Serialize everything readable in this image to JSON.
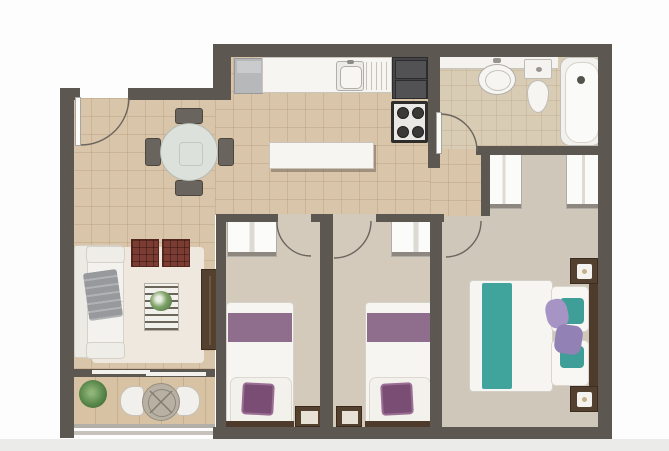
{
  "image_type": "top-down 2D architectural floor plan of a two-bedroom apartment, no visible text labels",
  "colors": {
    "wall": "#5d5751",
    "floor_tile": "#d9c5a9",
    "floor_bath": "#d9ccb5",
    "floor_bed": "#d3cabc",
    "floor_master": "#cfc7ba",
    "floor_terrace": "#d7c3a3",
    "white_furn": "#f6f5f1",
    "furn_border": "#c9c5bd",
    "wood": "#54402e",
    "purple_band": "#8f6d8c",
    "purple_cushion": "#7a4e74",
    "teal": "#41a49c",
    "lavender": "#a694c4",
    "appliance": "#454547",
    "fridge": "#b6b8b9",
    "pouf": "#7b3d33",
    "throw": "#97999d",
    "rug": "#eee8de",
    "glass": "#dce1dc",
    "railing": "#b3afa8",
    "arc": "#6b655e",
    "headboard": "#4f3b2c",
    "bottom_fade": "#ebebea"
  },
  "rooms": [
    {
      "name": "entry-dining",
      "items": [
        "entrance-door",
        "round-dining-table",
        "four-dining-chairs"
      ]
    },
    {
      "name": "kitchen",
      "items": [
        "refrigerator",
        "counter-with-sink-and-drainboard",
        "oven-microwave-tower",
        "cooktop-four-burners",
        "island-counter"
      ]
    },
    {
      "name": "bathroom",
      "items": [
        "vanity-counter",
        "round-basin-sink",
        "toilet",
        "bathtub",
        "bathroom-door"
      ]
    },
    {
      "name": "living-room",
      "items": [
        "sofa-with-gray-throw",
        "area-rug",
        "two-checkered-poufs",
        "slatted-coffee-table-with-plant",
        "tv-console"
      ]
    },
    {
      "name": "terrace",
      "items": [
        "potted-plant",
        "round-wicker-table",
        "two-bistro-chairs",
        "balcony-railing",
        "sliding-door"
      ]
    },
    {
      "name": "bedroom-1",
      "items": [
        "wardrobe",
        "single-bed-purple-accent",
        "purple-cushion",
        "wall-frame",
        "door"
      ]
    },
    {
      "name": "bedroom-2",
      "items": [
        "wardrobe",
        "single-bed-purple-accent",
        "purple-cushion",
        "wall-frame",
        "door"
      ]
    },
    {
      "name": "master-bedroom",
      "items": [
        "two-wardrobes",
        "double-bed-teal-stripes",
        "pillows",
        "lavender-cushions",
        "two-nightstands-with-lamps",
        "door"
      ]
    }
  ]
}
